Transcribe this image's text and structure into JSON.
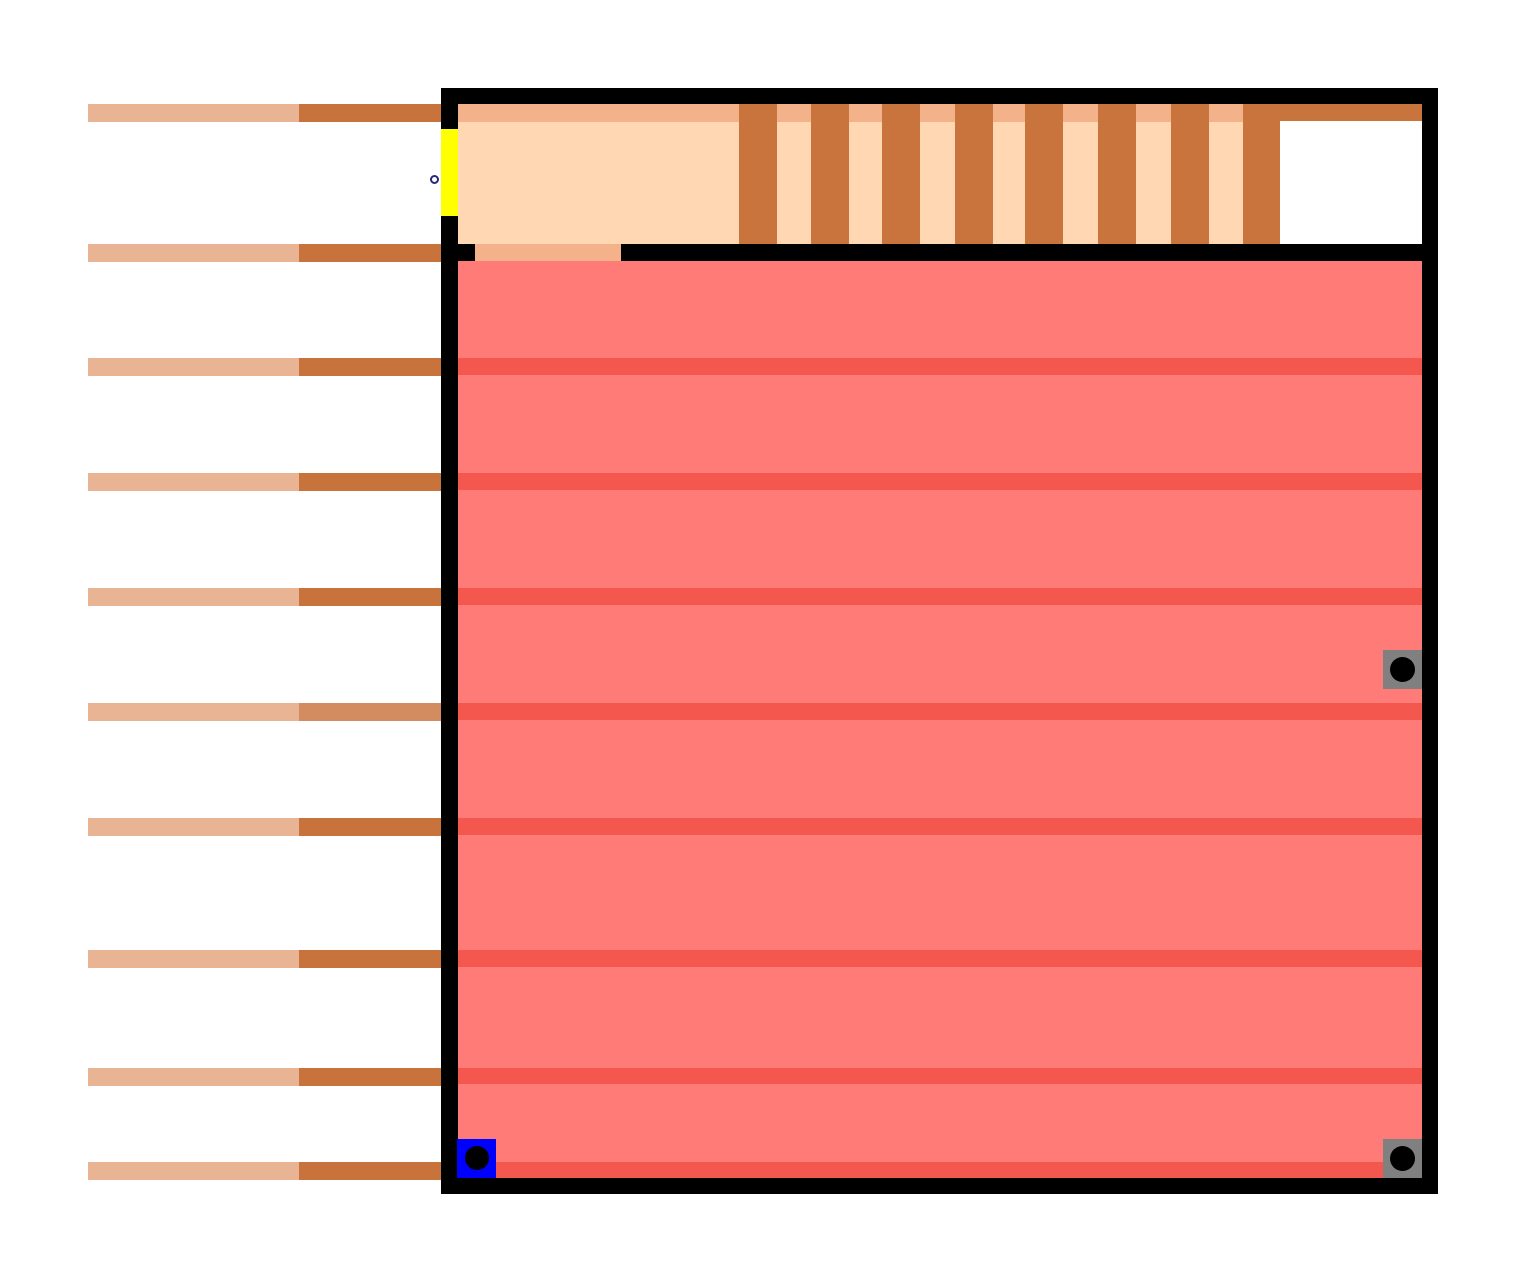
{
  "canvas": {
    "width": 1527,
    "height": 1283,
    "background": "#ffffff"
  },
  "colors": {
    "bar_tan": "#e8b493",
    "bar_brown": "#c8723c",
    "bar_brown_light": "#d28c5f",
    "wall_black": "#000000",
    "peach_light": "#ffd7b2",
    "peach_dark": "#f3b28a",
    "comb_brown": "#c8743c",
    "pool_red": "#ff7b78",
    "pool_stripe_red": "#f3574d",
    "door_yellow": "#ffff00",
    "switch_gray": "#808080",
    "switch_blue": "#0000ff",
    "dot_black": "#000000",
    "marker_ring_navy": "#28287e",
    "alcove_white": "#ffffff"
  },
  "scene": {
    "groups": [
      {
        "name": "left-wall-bars-layer",
        "items": [
          {
            "name": "wall-bar-tan-segment",
            "x": 88,
            "y": 104,
            "w": 211,
            "h": 18,
            "color": "#e8b493"
          },
          {
            "name": "wall-bar-brown-segment",
            "x": 299,
            "y": 104,
            "w": 142,
            "h": 18,
            "color": "#c8723c"
          },
          {
            "name": "wall-bar-tan-segment",
            "x": 88,
            "y": 244,
            "w": 211,
            "h": 18,
            "color": "#e8b493"
          },
          {
            "name": "wall-bar-brown-segment",
            "x": 299,
            "y": 244,
            "w": 142,
            "h": 18,
            "color": "#c8723c"
          },
          {
            "name": "wall-bar-tan-segment",
            "x": 88,
            "y": 358,
            "w": 211,
            "h": 18,
            "color": "#e8b493"
          },
          {
            "name": "wall-bar-brown-segment",
            "x": 299,
            "y": 358,
            "w": 142,
            "h": 18,
            "color": "#c8723c"
          },
          {
            "name": "wall-bar-tan-segment",
            "x": 88,
            "y": 473,
            "w": 211,
            "h": 18,
            "color": "#e8b493"
          },
          {
            "name": "wall-bar-brown-segment",
            "x": 299,
            "y": 473,
            "w": 142,
            "h": 18,
            "color": "#c8723c"
          },
          {
            "name": "wall-bar-tan-segment",
            "x": 88,
            "y": 588,
            "w": 211,
            "h": 18,
            "color": "#e8b493"
          },
          {
            "name": "wall-bar-brown-segment",
            "x": 299,
            "y": 588,
            "w": 142,
            "h": 18,
            "color": "#c8723c"
          },
          {
            "name": "wall-bar-tan-segment",
            "x": 88,
            "y": 703,
            "w": 211,
            "h": 18,
            "color": "#e8b493"
          },
          {
            "name": "wall-bar-brown-segment",
            "x": 299,
            "y": 703,
            "w": 142,
            "h": 18,
            "color": "#d28c5f"
          },
          {
            "name": "wall-bar-tan-segment",
            "x": 88,
            "y": 818,
            "w": 211,
            "h": 18,
            "color": "#e8b493"
          },
          {
            "name": "wall-bar-brown-segment",
            "x": 299,
            "y": 818,
            "w": 142,
            "h": 18,
            "color": "#c8723c"
          },
          {
            "name": "wall-bar-tan-segment",
            "x": 88,
            "y": 950,
            "w": 211,
            "h": 18,
            "color": "#e8b493"
          },
          {
            "name": "wall-bar-brown-segment",
            "x": 299,
            "y": 950,
            "w": 142,
            "h": 18,
            "color": "#c8723c"
          },
          {
            "name": "wall-bar-tan-segment",
            "x": 88,
            "y": 1068,
            "w": 211,
            "h": 18,
            "color": "#e8b493"
          },
          {
            "name": "wall-bar-brown-segment",
            "x": 299,
            "y": 1068,
            "w": 142,
            "h": 18,
            "color": "#c8723c"
          },
          {
            "name": "wall-bar-tan-segment",
            "x": 88,
            "y": 1162,
            "w": 211,
            "h": 18,
            "color": "#e8b493"
          },
          {
            "name": "wall-bar-brown-segment",
            "x": 299,
            "y": 1162,
            "w": 142,
            "h": 18,
            "color": "#c8723c"
          }
        ]
      },
      {
        "name": "room-frame",
        "items": [
          {
            "name": "room-wall-top",
            "x": 441,
            "y": 88,
            "w": 997,
            "h": 16,
            "color": "#000000"
          },
          {
            "name": "room-wall-left",
            "x": 441,
            "y": 104,
            "w": 17,
            "h": 1074,
            "color": "#000000"
          },
          {
            "name": "room-wall-right",
            "x": 1422,
            "y": 104,
            "w": 16,
            "h": 1074,
            "color": "#000000"
          },
          {
            "name": "room-wall-bottom",
            "x": 441,
            "y": 1178,
            "w": 997,
            "h": 16,
            "color": "#000000"
          }
        ]
      },
      {
        "name": "top-gallery",
        "items": [
          {
            "name": "gallery-peach-floor",
            "x": 458,
            "y": 104,
            "w": 822,
            "h": 140,
            "color": "#ffd7b2"
          },
          {
            "name": "gallery-peach-top-strip",
            "x": 458,
            "y": 104,
            "w": 822,
            "h": 18,
            "color": "#f3b28a"
          },
          {
            "name": "comb-tooth",
            "x": 739,
            "y": 104,
            "w": 38,
            "h": 140,
            "color": "#c8743c"
          },
          {
            "name": "comb-tooth",
            "x": 811,
            "y": 104,
            "w": 38,
            "h": 140,
            "color": "#c8743c"
          },
          {
            "name": "comb-tooth",
            "x": 882,
            "y": 104,
            "w": 38,
            "h": 140,
            "color": "#c8743c"
          },
          {
            "name": "comb-tooth",
            "x": 955,
            "y": 104,
            "w": 38,
            "h": 140,
            "color": "#c8743c"
          },
          {
            "name": "comb-tooth",
            "x": 1025,
            "y": 104,
            "w": 38,
            "h": 140,
            "color": "#c8743c"
          },
          {
            "name": "comb-tooth",
            "x": 1098,
            "y": 104,
            "w": 38,
            "h": 140,
            "color": "#c8743c"
          },
          {
            "name": "comb-tooth",
            "x": 1171,
            "y": 104,
            "w": 38,
            "h": 140,
            "color": "#c8743c"
          },
          {
            "name": "comb-tooth",
            "x": 1243,
            "y": 104,
            "w": 38,
            "h": 140,
            "color": "#c8743c"
          },
          {
            "name": "alcove-white-area",
            "x": 1280,
            "y": 121,
            "w": 142,
            "h": 123,
            "color": "#ffffff"
          },
          {
            "name": "alcove-brown-lintel",
            "x": 1280,
            "y": 104,
            "w": 142,
            "h": 17,
            "color": "#c8743c"
          }
        ]
      },
      {
        "name": "separator-ledge",
        "items": [
          {
            "name": "separator-black-line",
            "x": 458,
            "y": 244,
            "w": 964,
            "h": 17,
            "color": "#000000"
          },
          {
            "name": "separator-tan-ledge",
            "x": 475,
            "y": 244,
            "w": 146,
            "h": 17,
            "color": "#f3b28a"
          }
        ]
      },
      {
        "name": "red-pool",
        "items": [
          {
            "name": "pool-body",
            "x": 458,
            "y": 261,
            "w": 964,
            "h": 917,
            "color": "#ff7b78"
          },
          {
            "name": "pool-wave-stripe",
            "x": 458,
            "y": 358,
            "w": 964,
            "h": 17,
            "color": "#f3574d"
          },
          {
            "name": "pool-wave-stripe",
            "x": 458,
            "y": 473,
            "w": 964,
            "h": 17,
            "color": "#f3574d"
          },
          {
            "name": "pool-wave-stripe",
            "x": 458,
            "y": 588,
            "w": 964,
            "h": 17,
            "color": "#f3574d"
          },
          {
            "name": "pool-wave-stripe",
            "x": 458,
            "y": 703,
            "w": 964,
            "h": 17,
            "color": "#f3574d"
          },
          {
            "name": "pool-wave-stripe",
            "x": 458,
            "y": 818,
            "w": 964,
            "h": 17,
            "color": "#f3574d"
          },
          {
            "name": "pool-wave-stripe",
            "x": 458,
            "y": 950,
            "w": 964,
            "h": 17,
            "color": "#f3574d"
          },
          {
            "name": "pool-wave-stripe",
            "x": 458,
            "y": 1068,
            "w": 964,
            "h": 16,
            "color": "#f3574d"
          },
          {
            "name": "pool-wave-stripe",
            "x": 458,
            "y": 1162,
            "w": 964,
            "h": 16,
            "color": "#f3574d"
          }
        ]
      },
      {
        "name": "interactive-objects",
        "items": [
          {
            "name": "yellow-door",
            "x": 441,
            "y": 129,
            "w": 17,
            "h": 87,
            "color": "#ffff00",
            "interactable": true
          },
          {
            "name": "door-marker-circle",
            "type": "circle",
            "x": 430,
            "y": 175,
            "w": 9,
            "h": 9,
            "ring": "#28287e",
            "fill": "#ffffff",
            "interactable": true
          },
          {
            "name": "blue-switch-plate",
            "x": 457,
            "y": 1139,
            "w": 39,
            "h": 39,
            "color": "#0000ff",
            "interactable": true
          },
          {
            "name": "blue-switch-dot",
            "type": "circle",
            "x": 465,
            "y": 1146,
            "w": 24,
            "h": 24,
            "color": "#000000",
            "interactable": false
          },
          {
            "name": "gray-switch-plate-right-middle",
            "x": 1383,
            "y": 650,
            "w": 39,
            "h": 39,
            "color": "#808080",
            "interactable": true
          },
          {
            "name": "gray-switch-dot",
            "type": "circle",
            "x": 1390,
            "y": 657,
            "w": 25,
            "h": 25,
            "color": "#000000",
            "interactable": false
          },
          {
            "name": "gray-switch-plate-bottom-right",
            "x": 1383,
            "y": 1139,
            "w": 39,
            "h": 39,
            "color": "#808080",
            "interactable": true
          },
          {
            "name": "gray-switch-dot",
            "type": "circle",
            "x": 1390,
            "y": 1146,
            "w": 25,
            "h": 25,
            "color": "#000000",
            "interactable": false
          }
        ]
      }
    ]
  }
}
